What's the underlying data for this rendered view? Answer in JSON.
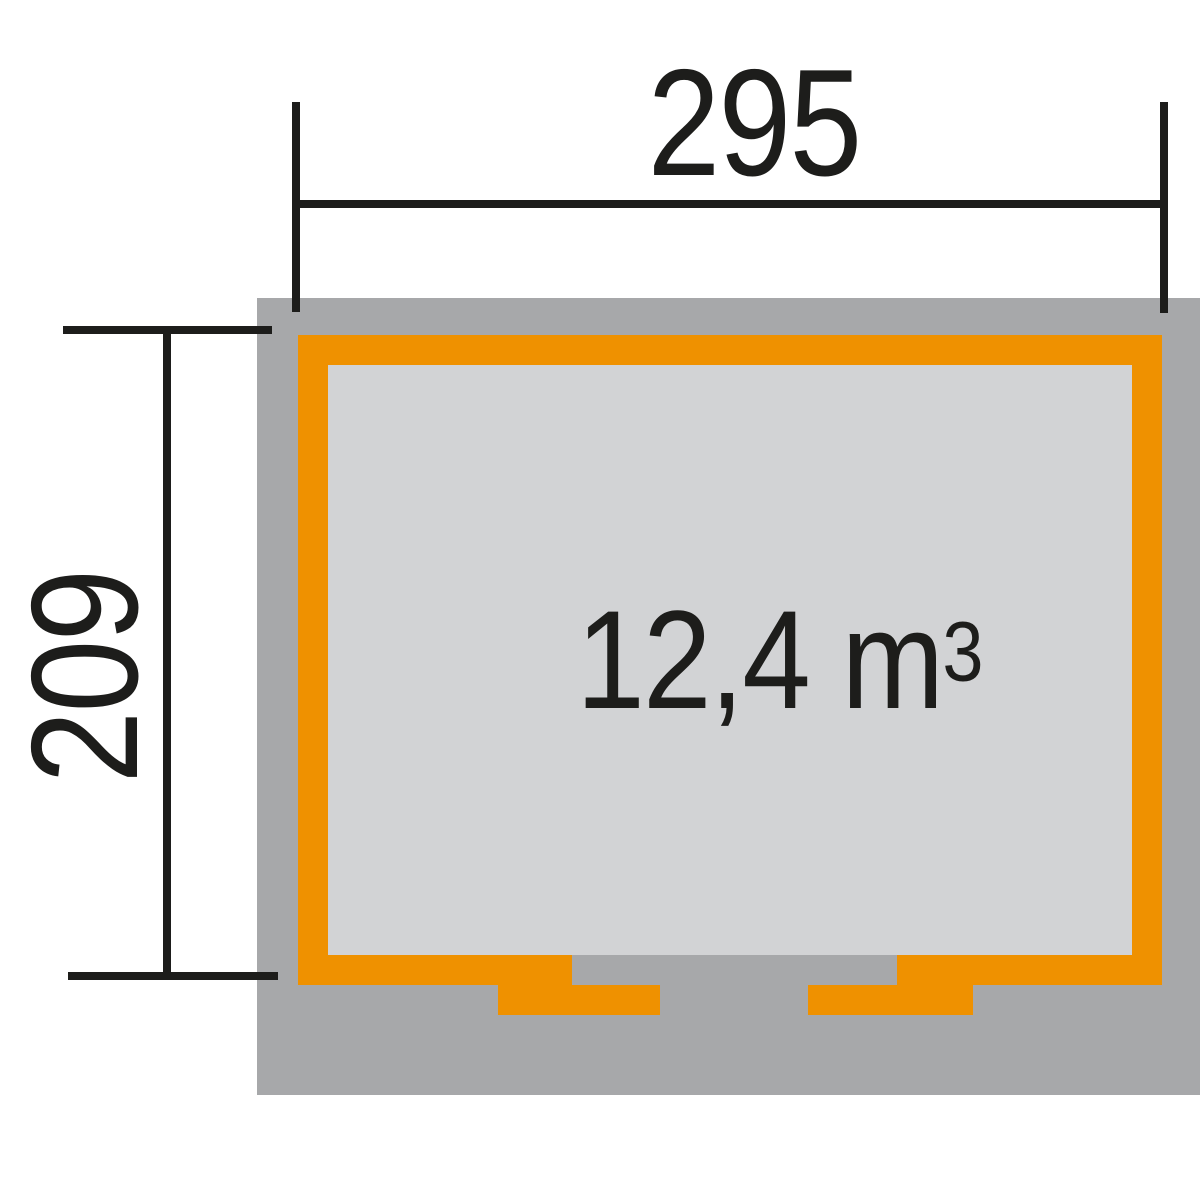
{
  "diagram": {
    "type": "garden-house-floor-plan",
    "width_label": "295",
    "depth_label": "209",
    "volume": {
      "value": "12,4 m",
      "sup": "3"
    }
  },
  "colors": {
    "accent_orange": "#ef9100",
    "footprint_gray": "#a7a8aa",
    "interior_gray": "#d2d3d5",
    "line_black": "#1d1d1b",
    "background": "#ffffff"
  }
}
